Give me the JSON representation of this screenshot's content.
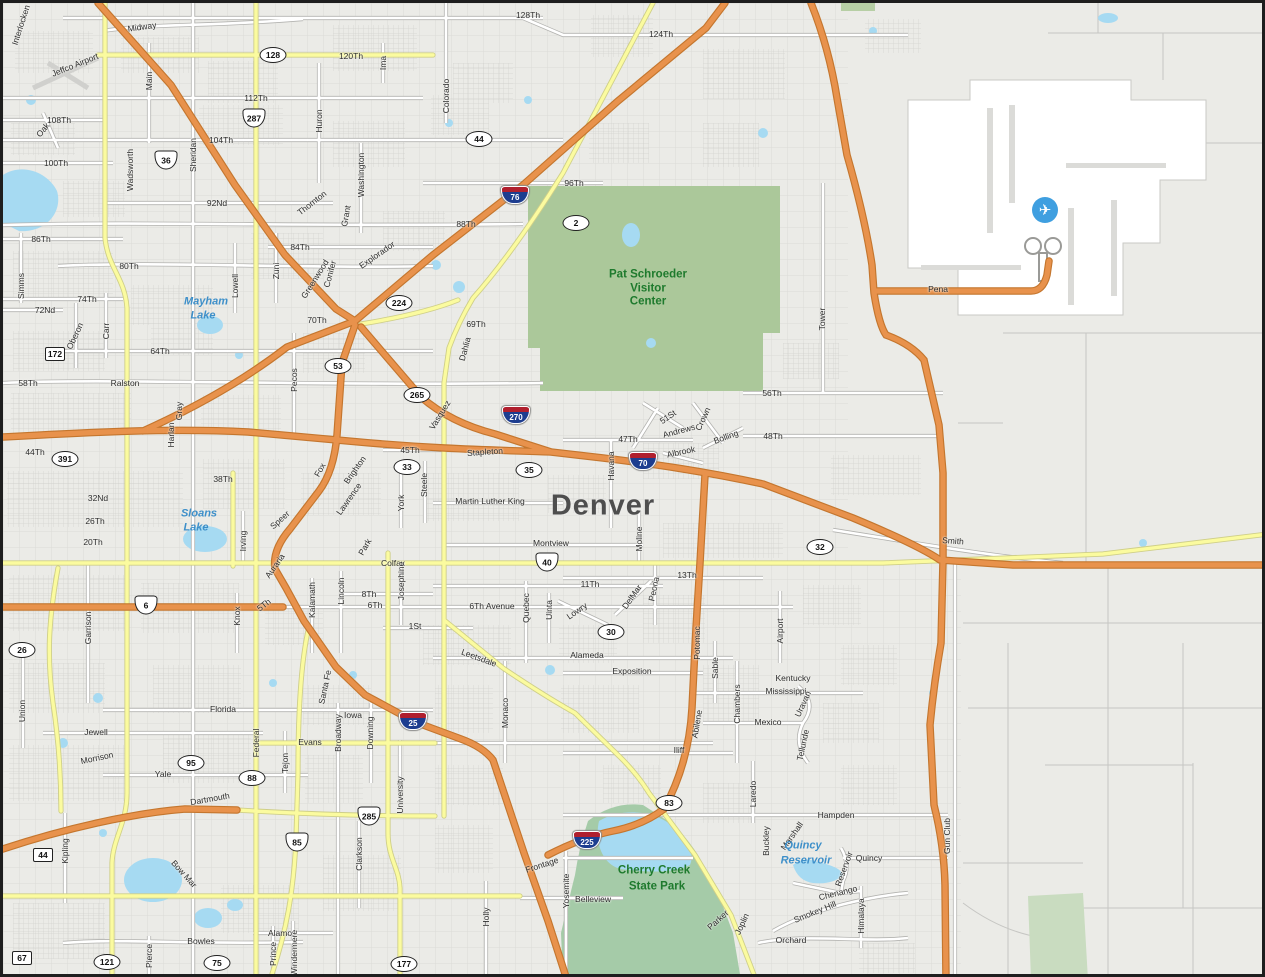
{
  "city": "Denver",
  "icons": {
    "airport_glyph": "✈",
    "airport_icon_x": 1042,
    "airport_icon_y": 207
  },
  "colors": {
    "background": "#EBEBE7",
    "highway_orange": "#E8924C",
    "major_yellow": "#FBFB9F",
    "park_green": "#ABC89A",
    "water_blue": "#A6DAF2",
    "airport_white": "#FFFFFF",
    "interstate_shield_blue": "#1d3d8f",
    "interstate_shield_red": "#b01f2e",
    "park_label_green": "#1e7a2d",
    "water_label_blue": "#3d8fc9"
  },
  "labels": {
    "streets": [
      [
        "Interlocken",
        18,
        22,
        -72
      ],
      [
        "Midway",
        139,
        24,
        -8
      ],
      [
        "Jeffco Airport",
        72,
        62,
        -22
      ],
      [
        "128Th",
        525,
        12,
        0
      ],
      [
        "124Th",
        658,
        31,
        0
      ],
      [
        "120Th",
        348,
        53,
        0
      ],
      [
        "112Th",
        253,
        95,
        0
      ],
      [
        "104Th",
        218,
        137,
        0
      ],
      [
        "108Th",
        56,
        117,
        0
      ],
      [
        "Oak",
        40,
        127,
        -50
      ],
      [
        "100Th",
        53,
        160,
        0
      ],
      [
        "Main",
        146,
        78,
        -90
      ],
      [
        "Huron",
        316,
        118,
        -90
      ],
      [
        "Washington",
        358,
        172,
        -90
      ],
      [
        "Colorado",
        443,
        93,
        -90
      ],
      [
        "Ima",
        380,
        60,
        -90
      ],
      [
        "Sheridan",
        190,
        152,
        -90
      ],
      [
        "Wadsworth",
        127,
        167,
        -90
      ],
      [
        "Thornton",
        309,
        200,
        -38
      ],
      [
        "Grant",
        343,
        213,
        -80
      ],
      [
        "96Th",
        571,
        180,
        0
      ],
      [
        "92Nd",
        214,
        200,
        0
      ],
      [
        "88Th",
        463,
        221,
        0
      ],
      [
        "86Th",
        38,
        236,
        0
      ],
      [
        "84Th",
        297,
        244,
        0
      ],
      [
        "80Th",
        126,
        263,
        0
      ],
      [
        "Zuni",
        273,
        268,
        -90
      ],
      [
        "Greenwood",
        312,
        276,
        -58
      ],
      [
        "Conifer",
        327,
        271,
        -75
      ],
      [
        "Explorador",
        374,
        252,
        -35
      ],
      [
        "Lowell",
        232,
        283,
        -90
      ],
      [
        "Simms",
        18,
        283,
        -90
      ],
      [
        "74Th",
        84,
        296,
        0
      ],
      [
        "72Nd",
        42,
        307,
        0
      ],
      [
        "70Th",
        314,
        317,
        0
      ],
      [
        "69Th",
        473,
        321,
        0
      ],
      [
        "Dahlia",
        462,
        346,
        -75
      ],
      [
        "64Th",
        157,
        348,
        0
      ],
      [
        "Carr",
        103,
        328,
        -90
      ],
      [
        "Oberon",
        72,
        333,
        -65
      ],
      [
        "Pecos",
        291,
        377,
        -90
      ],
      [
        "Ralston",
        122,
        380,
        0
      ],
      [
        "58Th",
        25,
        380,
        0
      ],
      [
        "56Th",
        769,
        390,
        0
      ],
      [
        "Tower",
        819,
        316,
        -90
      ],
      [
        "Pena",
        935,
        286,
        0
      ],
      [
        "48Th",
        770,
        433,
        0
      ],
      [
        "47Th",
        625,
        436,
        0
      ],
      [
        "45Th",
        407,
        447,
        0
      ],
      [
        "Stapleton",
        482,
        449,
        -4
      ],
      [
        "Vasquez",
        437,
        412,
        -58
      ],
      [
        "51St",
        665,
        414,
        -35
      ],
      [
        "Andrews",
        676,
        428,
        -15
      ],
      [
        "Crown",
        700,
        416,
        -65
      ],
      [
        "Bolling",
        723,
        434,
        -20
      ],
      [
        "Albrook",
        678,
        449,
        -12
      ],
      [
        "Harlan",
        168,
        432,
        -90
      ],
      [
        "Gray",
        176,
        408,
        -90
      ],
      [
        "44Th",
        32,
        449,
        0
      ],
      [
        "38Th",
        220,
        476,
        0
      ],
      [
        "Fox",
        317,
        467,
        -60
      ],
      [
        "Brighton",
        352,
        467,
        -55
      ],
      [
        "York",
        398,
        500,
        -90
      ],
      [
        "Steele",
        421,
        482,
        -90
      ],
      [
        "Havana",
        608,
        463,
        -90
      ],
      [
        "Martin Luther King",
        487,
        498,
        0
      ],
      [
        "Lawrence",
        346,
        496,
        -55
      ],
      [
        "Speer",
        277,
        517,
        -42
      ],
      [
        "32Nd",
        95,
        495,
        0
      ],
      [
        "26Th",
        92,
        518,
        0
      ],
      [
        "20Th",
        90,
        539,
        0
      ],
      [
        "Irving",
        240,
        538,
        -90
      ],
      [
        "Montview",
        548,
        540,
        0
      ],
      [
        "Moline",
        636,
        536,
        -90
      ],
      [
        "Park",
        362,
        544,
        -60
      ],
      [
        "Colfax",
        390,
        560,
        0
      ],
      [
        "Smith",
        950,
        538,
        4
      ],
      [
        "13Th",
        684,
        572,
        0
      ],
      [
        "11Th",
        587,
        581,
        0
      ],
      [
        "Auraria",
        272,
        563,
        -55
      ],
      [
        "Josephine",
        398,
        578,
        -90
      ],
      [
        "8Th",
        366,
        591,
        0
      ],
      [
        "6Th",
        372,
        602,
        0
      ],
      [
        "6Th Avenue",
        489,
        603,
        0
      ],
      [
        "5Th",
        261,
        602,
        -38
      ],
      [
        "Knox",
        234,
        613,
        -90
      ],
      [
        "Kalamath",
        309,
        597,
        -90
      ],
      [
        "Lincoln",
        338,
        588,
        -90
      ],
      [
        "Quebec",
        523,
        605,
        -90
      ],
      [
        "Uinta",
        546,
        607,
        -90
      ],
      [
        "Lowry",
        574,
        608,
        -35
      ],
      [
        "DelMar",
        629,
        594,
        -55
      ],
      [
        "Peoria",
        651,
        586,
        -78
      ],
      [
        "Airport",
        777,
        628,
        -90
      ],
      [
        "Garrison",
        85,
        625,
        -90
      ],
      [
        "1St",
        412,
        623,
        0
      ],
      [
        "Leetsdale",
        476,
        655,
        20
      ],
      [
        "Alameda",
        584,
        652,
        0
      ],
      [
        "Exposition",
        629,
        668,
        0
      ],
      [
        "Monaco",
        502,
        710,
        -90
      ],
      [
        "Sable",
        712,
        665,
        -90
      ],
      [
        "Kentucky",
        790,
        675,
        0
      ],
      [
        "Mississippi",
        783,
        688,
        0
      ],
      [
        "Chambers",
        734,
        701,
        -90
      ],
      [
        "Potomac",
        694,
        640,
        -90
      ],
      [
        "Union",
        19,
        708,
        -90
      ],
      [
        "Florida",
        220,
        706,
        0
      ],
      [
        "Uravan",
        800,
        701,
        -65
      ],
      [
        "Mexico",
        765,
        719,
        0
      ],
      [
        "Abilene",
        694,
        721,
        -80
      ],
      [
        "Iowa",
        350,
        712,
        0
      ],
      [
        "Jewell",
        93,
        729,
        0
      ],
      [
        "Federal",
        253,
        740,
        -90
      ],
      [
        "Broadway",
        335,
        730,
        -90
      ],
      [
        "Downing",
        367,
        730,
        -90
      ],
      [
        "Evans",
        307,
        739,
        0
      ],
      [
        "Tejon",
        282,
        760,
        -90
      ],
      [
        "Telluride",
        800,
        742,
        -78
      ],
      [
        "Iliff",
        676,
        747,
        0
      ],
      [
        "Santa Fe",
        322,
        684,
        -78
      ],
      [
        "Morrison",
        94,
        755,
        -12
      ],
      [
        "Yale",
        160,
        771,
        0
      ],
      [
        "Laredo",
        750,
        791,
        -90
      ],
      [
        "University",
        397,
        792,
        -90
      ],
      [
        "Dartmouth",
        207,
        796,
        -10
      ],
      [
        "Hampden",
        833,
        812,
        0
      ],
      [
        "Clarkson",
        356,
        851,
        -90
      ],
      [
        "Kipling",
        62,
        848,
        -90
      ],
      [
        "Buckley",
        763,
        838,
        -90
      ],
      [
        "Marshall",
        789,
        833,
        -55
      ],
      [
        "Frontage",
        539,
        862,
        -18
      ],
      [
        "Reservoir",
        841,
        866,
        -70
      ],
      [
        "Quincy",
        866,
        855,
        0
      ],
      [
        "Gun Club",
        944,
        833,
        -90
      ],
      [
        "Bow Mar",
        181,
        871,
        48
      ],
      [
        "Yosemite",
        563,
        888,
        -90
      ],
      [
        "Belleview",
        590,
        896,
        0
      ],
      [
        "Holly",
        483,
        914,
        -90
      ],
      [
        "Chenango",
        835,
        890,
        -14
      ],
      [
        "Parker",
        715,
        917,
        -42
      ],
      [
        "Smokey Hill",
        812,
        909,
        -22
      ],
      [
        "Himalaya",
        858,
        913,
        -90
      ],
      [
        "Joplin",
        739,
        921,
        -65
      ],
      [
        "Orchard",
        788,
        937,
        0
      ],
      [
        "Alamo",
        277,
        930,
        0
      ],
      [
        "Bowles",
        198,
        938,
        0
      ],
      [
        "Prince",
        270,
        951,
        -90
      ],
      [
        "Windermere",
        291,
        950,
        -90
      ],
      [
        "Pierce",
        146,
        953,
        -90
      ]
    ],
    "places": [
      [
        "Denver",
        600,
        503,
        "city"
      ],
      [
        "Pat Schroeder",
        645,
        272,
        "park"
      ],
      [
        "Visitor",
        645,
        286,
        "park"
      ],
      [
        "Center",
        645,
        299,
        "park"
      ],
      [
        "Cherry Creek",
        651,
        868,
        "park"
      ],
      [
        "State Park",
        654,
        884,
        "park"
      ],
      [
        "Mayham",
        203,
        299,
        "water"
      ],
      [
        "Lake",
        200,
        313,
        "water"
      ],
      [
        "Sloans",
        196,
        511,
        "water"
      ],
      [
        "Lake",
        193,
        525,
        "water"
      ],
      [
        "Quincy",
        800,
        843,
        "water"
      ],
      [
        "Reservoir",
        803,
        858,
        "water"
      ]
    ]
  },
  "shields": {
    "interstate": [
      [
        "76",
        512,
        192
      ],
      [
        "270",
        513,
        412
      ],
      [
        "70",
        640,
        458
      ],
      [
        "25",
        410,
        718
      ],
      [
        "225",
        584,
        837
      ]
    ],
    "us": [
      [
        "36",
        163,
        157
      ],
      [
        "287",
        251,
        115
      ],
      [
        "6",
        143,
        602
      ],
      [
        "40",
        544,
        559
      ],
      [
        "85",
        294,
        839
      ],
      [
        "285",
        366,
        813
      ]
    ],
    "state_oval": [
      [
        "128",
        270,
        52
      ],
      [
        "44",
        476,
        136
      ],
      [
        "2",
        573,
        220
      ],
      [
        "224",
        396,
        300
      ],
      [
        "53",
        335,
        363
      ],
      [
        "265",
        414,
        392
      ],
      [
        "33",
        404,
        464
      ],
      [
        "35",
        526,
        467
      ],
      [
        "391",
        62,
        456
      ],
      [
        "26",
        19,
        647
      ],
      [
        "30",
        608,
        629
      ],
      [
        "32",
        817,
        544
      ],
      [
        "83",
        666,
        800
      ],
      [
        "95",
        188,
        760
      ],
      [
        "88",
        249,
        775
      ],
      [
        "121",
        104,
        959
      ],
      [
        "75",
        214,
        960
      ],
      [
        "177",
        401,
        961
      ]
    ],
    "square": [
      [
        "172",
        52,
        351
      ],
      [
        "44",
        40,
        852
      ],
      [
        "67",
        19,
        955
      ]
    ]
  }
}
